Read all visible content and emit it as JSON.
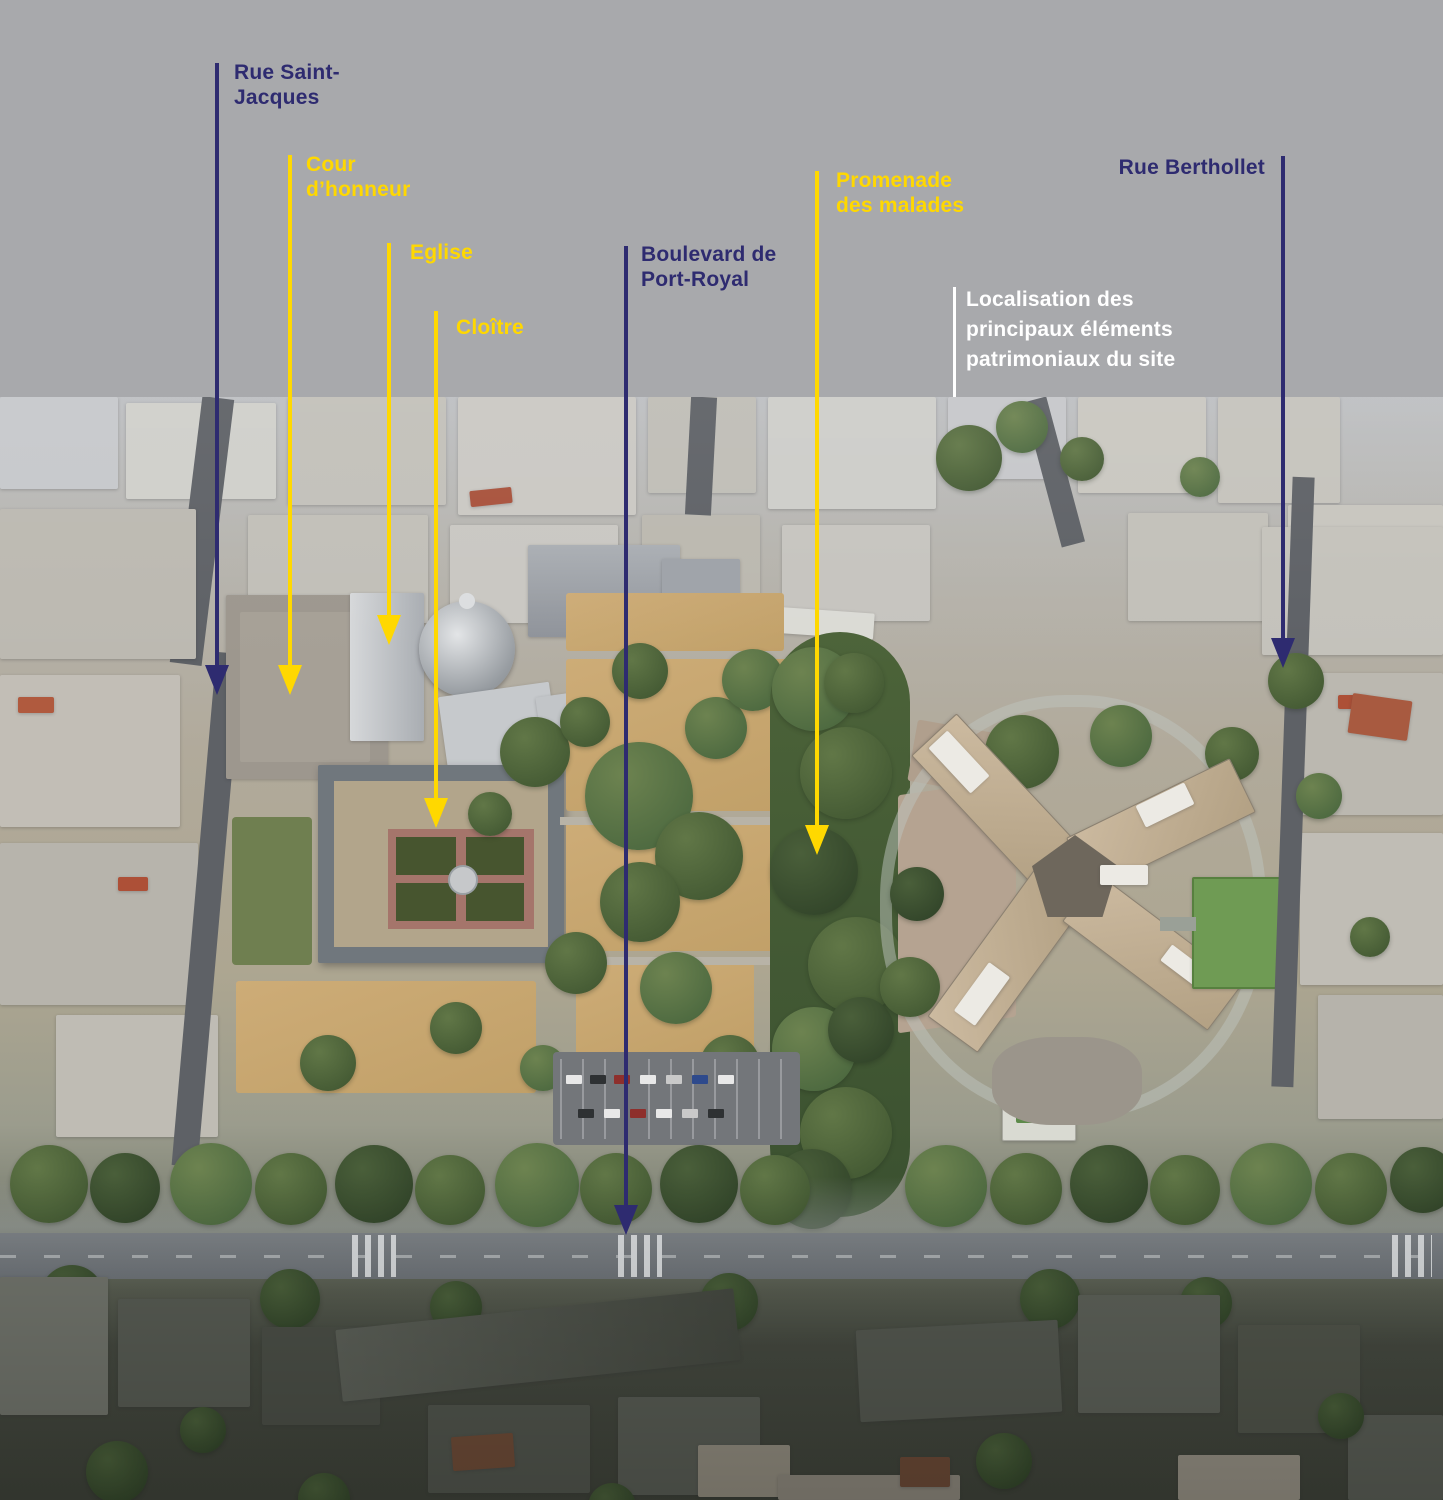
{
  "colors": {
    "band": "#a8a9ac",
    "navy": "#2e2b70",
    "yellow": "#ffd800",
    "white": "#ffffff"
  },
  "icons": {
    "arrow_down_marker": "triangle-down"
  },
  "legend": {
    "text": "Localisation des\nprincipaux éléments\npatrimoniaux du site"
  },
  "annotations": [
    {
      "id": "rue-saint-jacques",
      "label": "Rue Saint-\nJacques",
      "color": "navy"
    },
    {
      "id": "cour-dhonneur",
      "label": "Cour\nd’honneur",
      "color": "yellow"
    },
    {
      "id": "eglise",
      "label": "Eglise",
      "color": "yellow"
    },
    {
      "id": "cloitre",
      "label": "Cloître",
      "color": "yellow"
    },
    {
      "id": "boulevard-de-port-royal",
      "label": "Boulevard de\nPort-Royal",
      "color": "navy"
    },
    {
      "id": "promenade-des-malades",
      "label": "Promenade\ndes malades",
      "color": "yellow"
    },
    {
      "id": "rue-berthollet",
      "label": "Rue Berthollet",
      "color": "navy"
    }
  ]
}
